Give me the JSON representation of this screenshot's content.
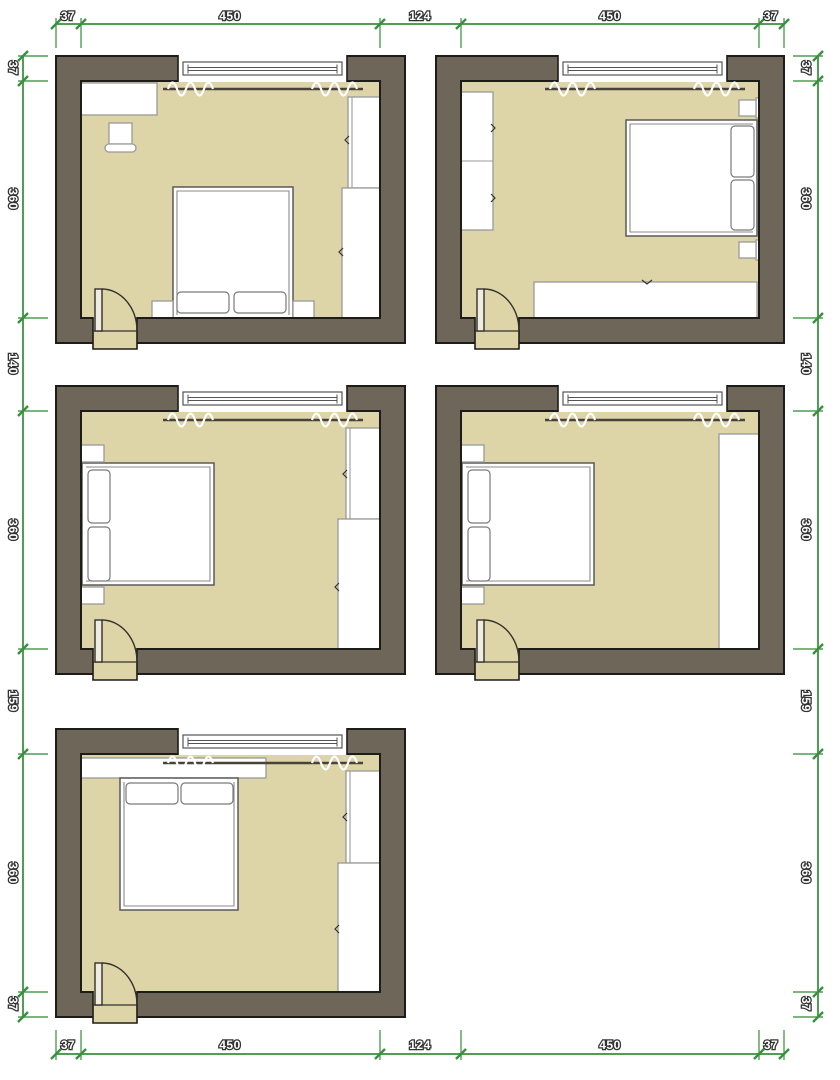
{
  "figure": {
    "type": "architectural-floor-plan",
    "description": "Five bedroom furniture layout options drawn as plan views with dimension chains",
    "rooms_shown": 5
  },
  "dimensions_cm": {
    "top": [
      "37",
      "450",
      "124",
      "450",
      "37"
    ],
    "bottom": [
      "37",
      "450",
      "124",
      "450",
      "37"
    ],
    "left": [
      "37",
      "360",
      "140",
      "360",
      "159",
      "360",
      "37"
    ],
    "right": [
      "37",
      "360",
      "140",
      "360",
      "159",
      "360",
      "37"
    ]
  },
  "colors": {
    "background": "#ffffff",
    "wall": "#6e6659",
    "wall_outline": "#1e1c18",
    "floor": "#ddd5a8",
    "dimension_line": "#4f9e53",
    "dimension_text_fill": "#ffffff",
    "dimension_text_outline": "#333333",
    "furniture_fill": "#ffffff",
    "door_leaf": "#efede2"
  },
  "rooms": [
    {
      "position": "top-left",
      "furniture": [
        "window",
        "curtains",
        "sideboard",
        "chair",
        "tall-wardrobe",
        "wide-wardrobe",
        "double-bed",
        "two-pillows",
        "nightstand-left",
        "nightstand-right",
        "door"
      ]
    },
    {
      "position": "top-right",
      "furniture": [
        "window",
        "curtains",
        "wardrobe",
        "double-bed",
        "two-pillows",
        "nightstand-top",
        "nightstand-bottom",
        "low-dresser",
        "door"
      ]
    },
    {
      "position": "middle-left",
      "furniture": [
        "window",
        "curtains",
        "double-bed",
        "two-pillows",
        "nightstand-top",
        "nightstand-bottom",
        "tall-wardrobe",
        "wide-wardrobe",
        "door"
      ]
    },
    {
      "position": "middle-right",
      "furniture": [
        "window",
        "curtains",
        "double-bed",
        "two-pillows",
        "nightstand-top",
        "nightstand-bottom",
        "full-wall-wardrobe",
        "door"
      ]
    },
    {
      "position": "bottom-left",
      "furniture": [
        "window",
        "curtains",
        "wall-shelf",
        "double-bed",
        "two-pillows",
        "tall-wardrobe",
        "wide-wardrobe",
        "door"
      ]
    }
  ]
}
